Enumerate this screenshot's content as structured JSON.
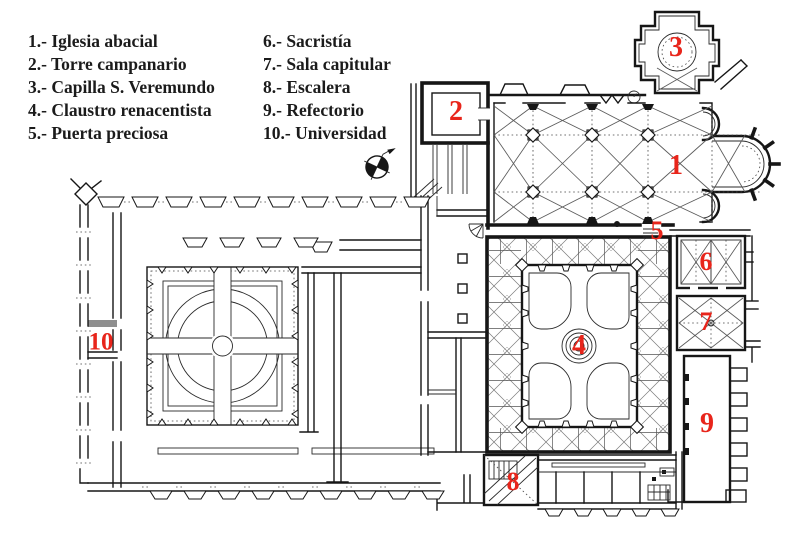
{
  "page": {
    "background": "#ffffff"
  },
  "legend": {
    "column1": [
      "1.- Iglesia abacial",
      "2.- Torre campanario",
      "3.- Capilla S. Veremundo",
      "4.- Claustro renacentista",
      "5.- Puerta preciosa"
    ],
    "column2": [
      "6.- Sacristía",
      "7.- Sala capitular",
      "8.- Escalera",
      "9.- Refectorio",
      "10.- Universidad"
    ]
  },
  "plan": {
    "type": "architectural-floor-plan",
    "colors": {
      "ink": "#161616",
      "label_red": "#e8251b",
      "background": "#ffffff"
    },
    "labels": [
      {
        "number": "1",
        "name": "Iglesia abacial",
        "x": 676,
        "y": 166,
        "size": 28
      },
      {
        "number": "2",
        "name": "Torre campanario",
        "x": 456,
        "y": 112,
        "size": 28
      },
      {
        "number": "3",
        "name": "Capilla S. Veremundo",
        "x": 676,
        "y": 48,
        "size": 28
      },
      {
        "number": "4",
        "name": "Claustro renacentista",
        "x": 579,
        "y": 346,
        "size": 28
      },
      {
        "number": "5",
        "name": "Puerta preciosa",
        "x": 657,
        "y": 231,
        "size": 26
      },
      {
        "number": "6",
        "name": "Sacristía",
        "x": 706,
        "y": 262,
        "size": 26
      },
      {
        "number": "7",
        "name": "Sala capitular",
        "x": 706,
        "y": 322,
        "size": 26
      },
      {
        "number": "8",
        "name": "Escalera",
        "x": 513,
        "y": 482,
        "size": 26
      },
      {
        "number": "9",
        "name": "Refectorio",
        "x": 707,
        "y": 424,
        "size": 28
      },
      {
        "number": "10",
        "name": "Universidad",
        "x": 101,
        "y": 342,
        "size": 25
      }
    ]
  }
}
